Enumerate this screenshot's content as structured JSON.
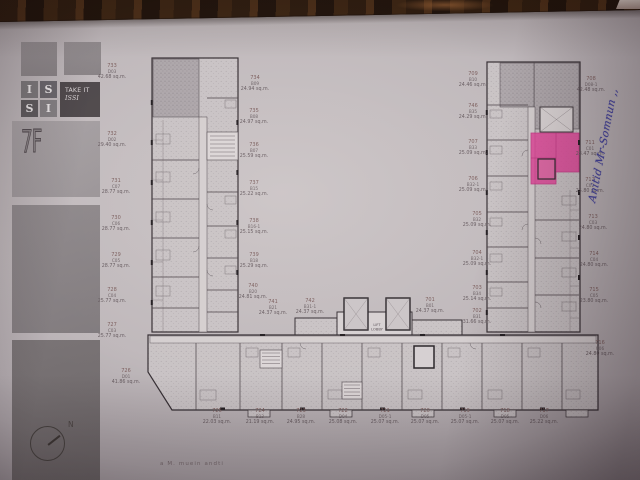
{
  "sidebar": {
    "brand_letters": [
      "I",
      "S",
      "S",
      "I"
    ],
    "brand_tagline_top": "TAKE IT",
    "brand_tagline_bottom": "ISSI",
    "floor_label": "7F",
    "compass_label": "N"
  },
  "plan": {
    "lift_label_line1": "LIFT",
    "lift_label_line2": "LOBBY",
    "highlight_color": "#e23e96",
    "highlighted_unit_number": "711",
    "annotation_text": "Anitid Mr-Somnun ,,",
    "bottom_partial_text": "a M. muein andti"
  },
  "units": [
    {
      "number": "733",
      "code": "D03",
      "area": "42.68 sq.m.",
      "x": 112,
      "y": 72
    },
    {
      "number": "732",
      "code": "D02",
      "area": "29.40 sq.m.",
      "x": 112,
      "y": 140
    },
    {
      "number": "731",
      "code": "C07",
      "area": "28.77 sq.m.",
      "x": 116,
      "y": 187
    },
    {
      "number": "730",
      "code": "C06",
      "area": "28.77 sq.m.",
      "x": 116,
      "y": 224
    },
    {
      "number": "729",
      "code": "C05",
      "area": "28.77 sq.m.",
      "x": 116,
      "y": 261
    },
    {
      "number": "728",
      "code": "C04",
      "area": "25.77 sq.m.",
      "x": 112,
      "y": 296
    },
    {
      "number": "727",
      "code": "C03",
      "area": "25.77 sq.m.",
      "x": 112,
      "y": 331
    },
    {
      "number": "726",
      "code": "D01",
      "area": "41.86 sq.m.",
      "x": 126,
      "y": 377
    },
    {
      "number": "734",
      "code": "B09",
      "area": "24.94 sq.m.",
      "x": 255,
      "y": 84
    },
    {
      "number": "735",
      "code": "B08",
      "area": "24.97 sq.m.",
      "x": 254,
      "y": 117
    },
    {
      "number": "736",
      "code": "B07",
      "area": "25.59 sq.m.",
      "x": 254,
      "y": 151
    },
    {
      "number": "737",
      "code": "B15",
      "area": "25.22 sq.m.",
      "x": 254,
      "y": 189
    },
    {
      "number": "738",
      "code": "B16-1",
      "area": "25.15 sq.m.",
      "x": 254,
      "y": 227
    },
    {
      "number": "739",
      "code": "B18",
      "area": "25.29 sq.m.",
      "x": 254,
      "y": 261
    },
    {
      "number": "740",
      "code": "B20",
      "area": "24.81 sq.m.",
      "x": 253,
      "y": 292
    },
    {
      "number": "741",
      "code": "B21",
      "area": "24.37 sq.m.",
      "x": 273,
      "y": 308
    },
    {
      "number": "742",
      "code": "B31-1",
      "area": "24.37 sq.m.",
      "x": 310,
      "y": 307
    },
    {
      "number": "701",
      "code": "B01",
      "area": "24.37 sq.m.",
      "x": 430,
      "y": 306
    },
    {
      "number": "709",
      "code": "B10",
      "area": "24.46 sq.m.",
      "x": 473,
      "y": 80
    },
    {
      "number": "746",
      "code": "B35",
      "area": "24.29 sq.m.",
      "x": 473,
      "y": 112
    },
    {
      "number": "707",
      "code": "B33",
      "area": "25.09 sq.m.",
      "x": 473,
      "y": 148
    },
    {
      "number": "706",
      "code": "B32-1",
      "area": "25.09 sq.m.",
      "x": 473,
      "y": 185
    },
    {
      "number": "705",
      "code": "B32",
      "area": "25.09 sq.m.",
      "x": 477,
      "y": 220
    },
    {
      "number": "704",
      "code": "B32-1",
      "area": "25.09 sq.m.",
      "x": 477,
      "y": 259
    },
    {
      "number": "703",
      "code": "B34",
      "area": "25.14 sq.m.",
      "x": 477,
      "y": 294
    },
    {
      "number": "702",
      "code": "B31",
      "area": "31.66 sq.m.",
      "x": 477,
      "y": 317
    },
    {
      "number": "708",
      "code": "D08-1",
      "area": "42.48 sq.m.",
      "x": 591,
      "y": 85
    },
    {
      "number": "711",
      "code": "C01",
      "area": "28.47 sq.m.",
      "x": 590,
      "y": 149
    },
    {
      "number": "712",
      "code": "C02",
      "area": "25.80 sq.m.",
      "x": 590,
      "y": 186
    },
    {
      "number": "713",
      "code": "C03",
      "area": "24.80 sq.m.",
      "x": 593,
      "y": 223
    },
    {
      "number": "714",
      "code": "C04",
      "area": "24.80 sq.m.",
      "x": 594,
      "y": 260
    },
    {
      "number": "715",
      "code": "C05",
      "area": "23.80 sq.m.",
      "x": 594,
      "y": 296
    },
    {
      "number": "716",
      "code": "C06",
      "area": "24.80 sq.m.",
      "x": 600,
      "y": 349
    },
    {
      "number": "725",
      "code": "B11",
      "area": "22.03 sq.m.",
      "x": 217,
      "y": 417
    },
    {
      "number": "724",
      "code": "B13",
      "area": "21.19 sq.m.",
      "x": 260,
      "y": 417
    },
    {
      "number": "723",
      "code": "B28",
      "area": "24.95 sq.m.",
      "x": 301,
      "y": 417
    },
    {
      "number": "722",
      "code": "D04",
      "area": "25.08 sq.m.",
      "x": 343,
      "y": 417
    },
    {
      "number": "721",
      "code": "D05-1",
      "area": "25.07 sq.m.",
      "x": 385,
      "y": 417
    },
    {
      "number": "720",
      "code": "D05",
      "area": "25.07 sq.m.",
      "x": 425,
      "y": 417
    },
    {
      "number": "719",
      "code": "D05-1",
      "area": "25.07 sq.m.",
      "x": 465,
      "y": 417
    },
    {
      "number": "718",
      "code": "D05",
      "area": "25.07 sq.m.",
      "x": 505,
      "y": 417
    },
    {
      "number": "717",
      "code": "D06",
      "area": "25.22 sq.m.",
      "x": 544,
      "y": 417
    }
  ]
}
